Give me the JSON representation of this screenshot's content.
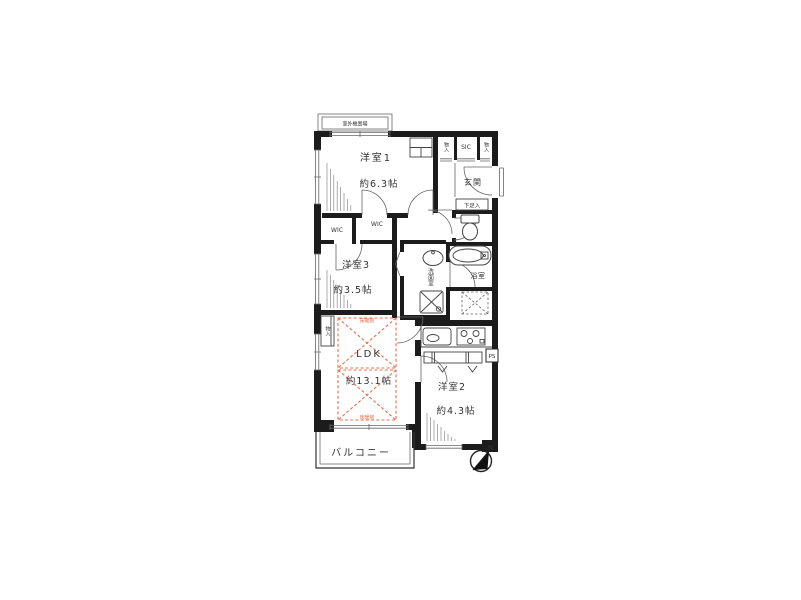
{
  "colors": {
    "wall": "#1c1c1c",
    "line": "#555555",
    "accent": "#e8714f",
    "text": "#333333"
  },
  "plan": {
    "outdoor_unit": "室外機置場",
    "rooms": {
      "room1": {
        "name": "洋室1",
        "size": "約6.3帖"
      },
      "room3": {
        "name": "洋室3",
        "size": "約3.5帖"
      },
      "room2": {
        "name": "洋室2",
        "size": "約4.3帖"
      },
      "ldk": {
        "name": "LDK",
        "size": "約13.1帖"
      },
      "entrance": "玄関",
      "bathroom": "浴室",
      "washroom": "洗面室",
      "balcony": "バルコニー"
    },
    "storage": {
      "sic": "SIC",
      "closet_top_left": "物入",
      "closet_top_right": "物入",
      "closet_ldk": "物入",
      "wic_left": "WIC",
      "wic_right": "WIC",
      "shoe_box": "下足入",
      "pipe_space": "PS"
    },
    "floor_heating": {
      "top": "床暖房",
      "bottom": "床暖房"
    },
    "compass": {
      "north": "N"
    }
  }
}
